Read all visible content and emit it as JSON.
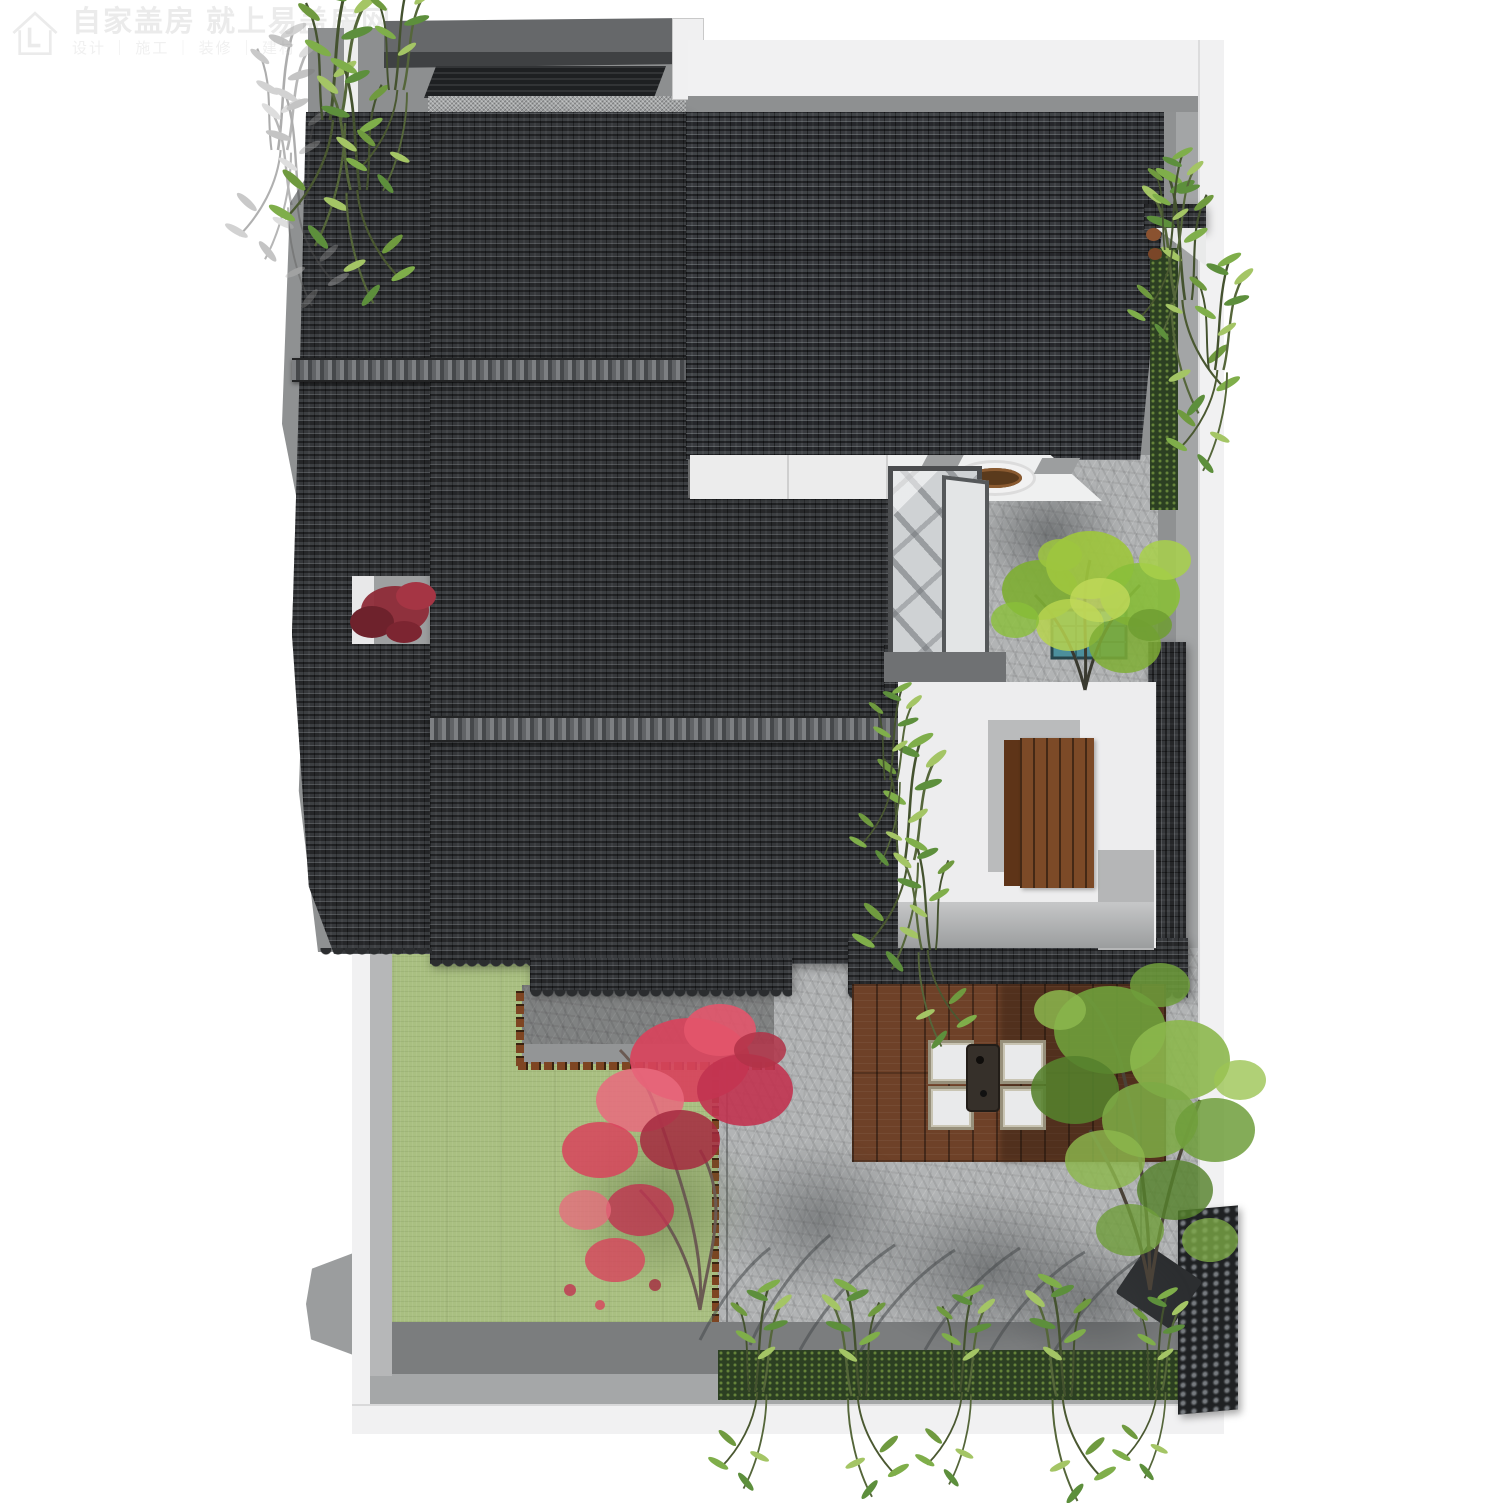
{
  "watermark": {
    "logo_icon": "house-logo-icon",
    "line1": "自家盖房 就上易盖房网",
    "line2": "设计 ｜ 施工 ｜ 装修 ｜ 建材 ｜ 家居"
  },
  "scene": {
    "description": "Top-down aerial 3D rendering of a Chinese-style courtyard residence: grey curved-tile gabled roofs, stone-paved courtyards, a white patio with a long wooden table, a timber deck with four white seats around a dark table, a green lawn, a red maple, bright green trees, bamboo rows along the walls, a glass atrium corridor and a dark stacked-tile screen wall",
    "furniture": {
      "deck_seats": 4,
      "deck_table": 1,
      "courtyard_table": 1,
      "round_basin": 1
    },
    "colors": {
      "page_bg": "#ffffff",
      "wall_white": "#f1f1f2",
      "wall_grey": "#8f9192",
      "deck_grey": "#8d8f90",
      "walkway_dark": "#7b7d7e",
      "roof_tile": "#35373a",
      "roof_ridge": "#6f7174",
      "stone_paving": "#b2b4b5",
      "lawn_green": "#a9bf81",
      "wood_deck": "#6e4128",
      "wood_table": "#7c4a27",
      "maple_red": "#d8435c",
      "shrub_dark_red": "#8e2b38",
      "tree_green": "#7fae35",
      "bamboo_green": "#5d8f3c",
      "hedge_green": "#2c3f22",
      "planter_blue": "#4c8f9c",
      "canopy_dark": "#1e2022",
      "watermark_grey": "#ebebeb"
    }
  }
}
